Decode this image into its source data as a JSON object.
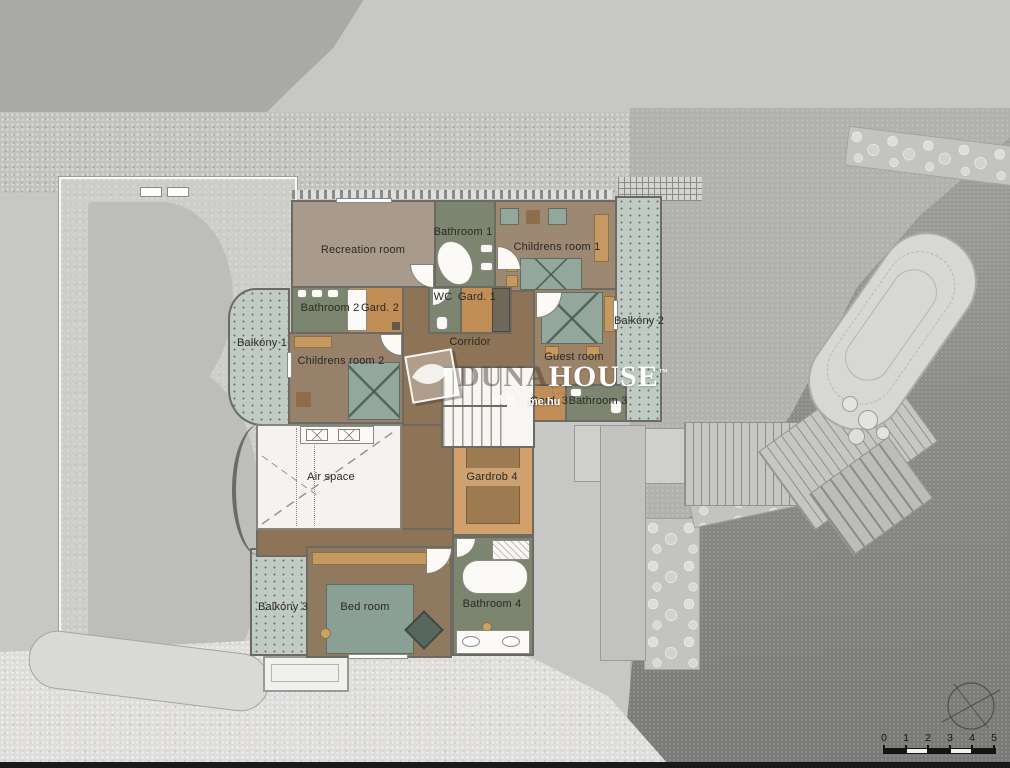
{
  "plan": {
    "rooms": {
      "recreation": "Recreation room",
      "bathroom1": "Bathroom 1",
      "childrens1": "Childrens room 1",
      "bathroom2": "Bathroom 2",
      "gard2": "Gard. 2",
      "wc": "WC",
      "gard1": "Gard. 1",
      "balkony1": "Balkóny 1",
      "childrens2": "Childrens room 2",
      "corridor": "Corridor",
      "guest": "Guest room",
      "balkony2": "Balkóny 2",
      "gard3": "Gard. 3",
      "bathroom3": "Bathroom 3",
      "airspace": "Air space",
      "gardrob4": "Gardrob 4",
      "balkony3": "Balkóny 3",
      "bedroom": "Bed room",
      "bathroom4": "Bathroom 4"
    },
    "watermark": {
      "left_text": "DUNA",
      "main_text": "HOUSE",
      "tm": "™",
      "sub_text": "ME",
      "url_text": "me.hu"
    },
    "scale_bar": {
      "ticks": [
        "0",
        "1",
        "2",
        "3",
        "4",
        "5"
      ]
    },
    "colors": {
      "room_taupe": "#a89b8b",
      "room_brown": "#9d8873",
      "room_green": "#7b8570",
      "room_orange": "#c28e58",
      "corridor_brown": "#8d7457",
      "balcony_teal": "#c0cbc4",
      "wall_gray": "#6d6a63",
      "site_dark": "#7d7d7b",
      "site_light": "#cdcdca"
    }
  }
}
